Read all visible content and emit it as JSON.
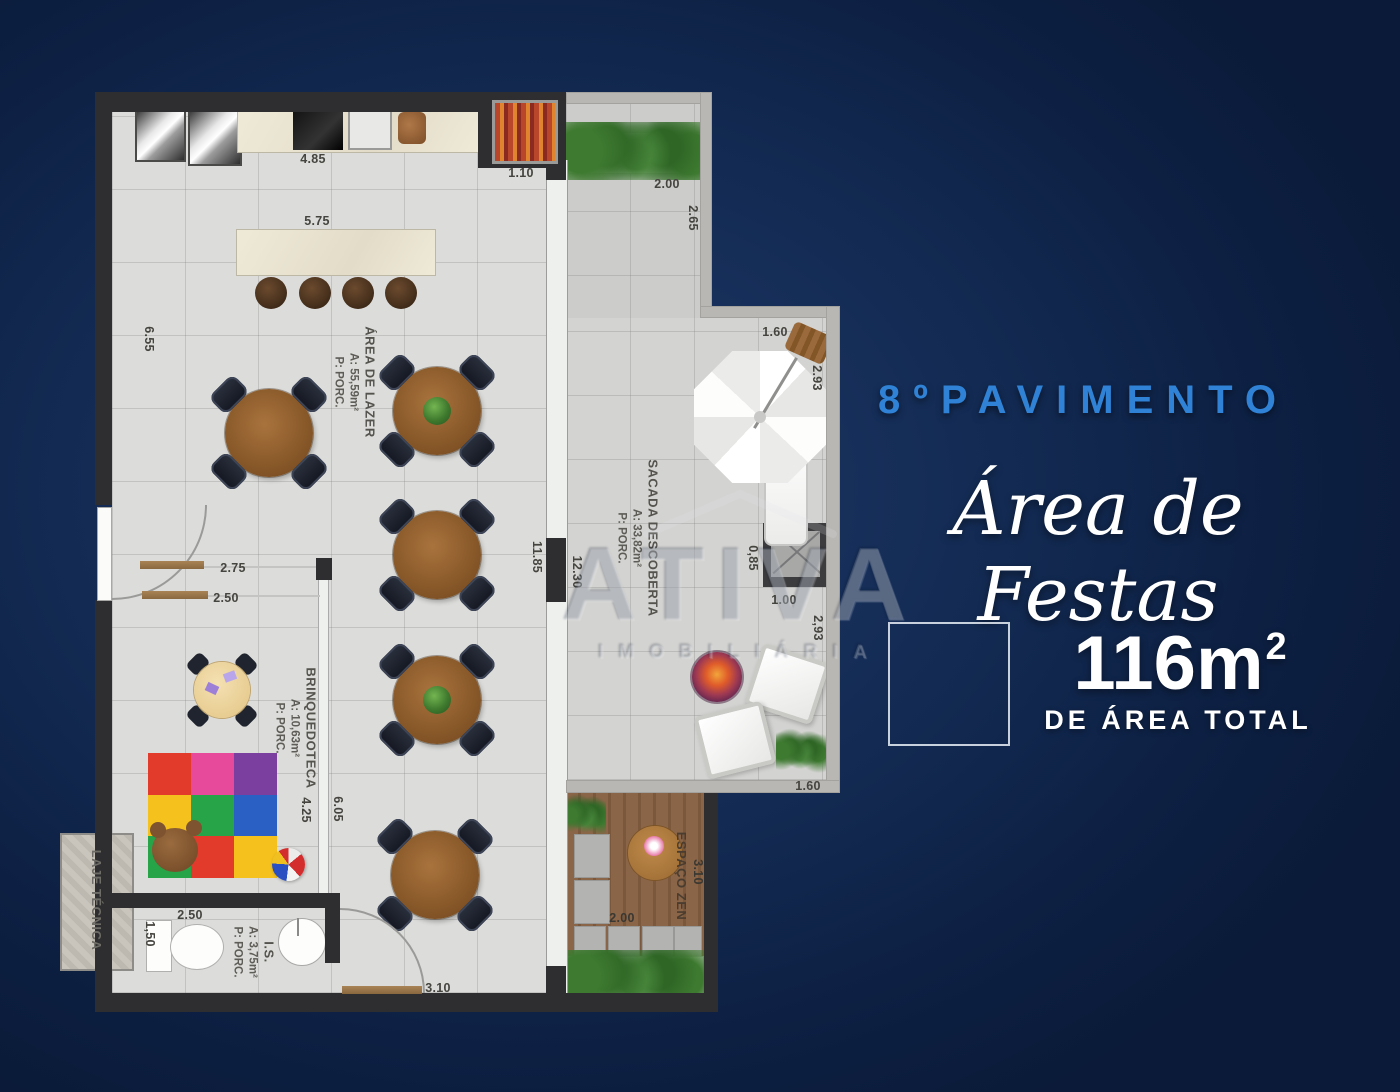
{
  "panel": {
    "floor_label": "8ºPAVIMENTO",
    "script_title": "Área de Festas",
    "area_value": "116m",
    "area_exponent": "2",
    "area_caption": "DE ÁREA TOTAL",
    "accent_color": "#2f82d6"
  },
  "watermark": {
    "brand": "ATIVA",
    "brand_sub": "IMOBILIÁRIA"
  },
  "rooms": {
    "lazer": {
      "name": "ÁREA DE LAZER",
      "area": "A: 55,59m²",
      "finish": "P: PORC."
    },
    "brinquedoteca": {
      "name": "BRINQUEDOTECA",
      "area": "A: 10,63m²",
      "finish": "P: PORC."
    },
    "sacada": {
      "name": "SACADA DESCOBERTA",
      "area": "A: 33,82m²",
      "finish": "P: PORC."
    },
    "banheiro": {
      "name": "I.S.",
      "area": "A: 3,75m²",
      "finish": "P: PORC."
    },
    "laje": {
      "name": "LAJE TÉCNICA"
    },
    "zen": {
      "name": "ESPAÇO ZEN"
    }
  },
  "dims": {
    "counter": "4.85",
    "grill": "1.10",
    "balcony_top": "2.00",
    "balcony_right": "2.65",
    "island": "5.75",
    "left_wall": "6.55",
    "umbrella_top": "1.60",
    "umbrella_right": "2.93",
    "glass_inner": "11.85",
    "glass_outer": "12.30",
    "ac_side": "0,85",
    "ac_front": "1.00",
    "lounge_right": "2,93",
    "opening_top": "2.75",
    "opening_bottom": "2.50",
    "room_len_inner": "4.25",
    "room_len_outer": "6.05",
    "lounge_bottom": "1.60",
    "zen_width": "2.00",
    "zen_depth": "3.10",
    "bath_width": "2.50",
    "bath_depth": "1,50",
    "bottom_door": "3.10"
  }
}
